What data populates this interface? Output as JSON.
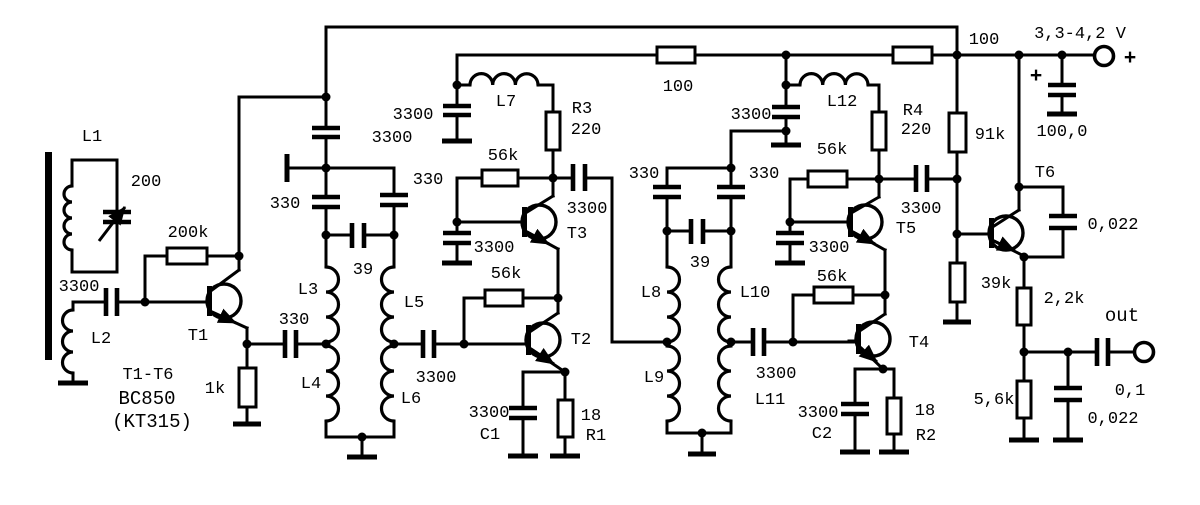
{
  "labels": {
    "input": {
      "l1": "L1",
      "c_tune": "200",
      "c_in": "3300",
      "l2": "L2"
    },
    "t1": {
      "r_bias": "200k",
      "name": "T1",
      "r_emitter": "1k",
      "c_emitter": "330",
      "note1": "T1-T6",
      "note2": "BC850",
      "note3": "(KT315)"
    },
    "filter1": {
      "c_decouple": "3300",
      "c_left": "330",
      "c_right": "330",
      "c_bridge": "39",
      "l3": "L3",
      "l4": "L4",
      "l5": "L5",
      "l6": "L6",
      "c_out": "3300"
    },
    "amp1": {
      "c_decouple": "3300",
      "l7": "L7",
      "r3_name": "R3",
      "r3_value": "220",
      "r_fb_upper": "56k",
      "c_couple": "3300",
      "t3_name": "T3",
      "c_base": "3300",
      "r_fb_lower": "56k",
      "t2_name": "T2",
      "c1_value": "3300",
      "c1_name": "C1",
      "r1_value": "18",
      "r1_name": "R1"
    },
    "supply": {
      "r_dec_1": "100",
      "r_dec_2": "100",
      "voltage": "3,3-4,2 V",
      "terminal_plus": "+",
      "cap_plus": "+",
      "c_filter": "100,0"
    },
    "filter2": {
      "c_decouple": "3300",
      "c_left": "330",
      "c_right": "330",
      "c_bridge": "39",
      "l8": "L8",
      "l9": "L9",
      "l10": "L10",
      "l11": "L11",
      "c_out": "3300"
    },
    "amp2": {
      "l12": "L12",
      "r4_name": "R4",
      "r4_value": "220",
      "r_fb_upper": "56k",
      "c_couple": "3300",
      "t5_name": "T5",
      "c_base": "3300",
      "r_fb_lower": "56k",
      "t4_name": "T4",
      "c2_value": "3300",
      "c2_name": "C2",
      "r2_value": "18",
      "r2_name": "R2"
    },
    "out_stage": {
      "r_upper": "91k",
      "r_lower": "39k",
      "t6_name": "T6",
      "c_feedback": "0,022",
      "r_e1": "2,2k",
      "r_e2": "5,6k",
      "c_out": "0,1",
      "c_bypass": "0,022",
      "out": "out"
    }
  }
}
